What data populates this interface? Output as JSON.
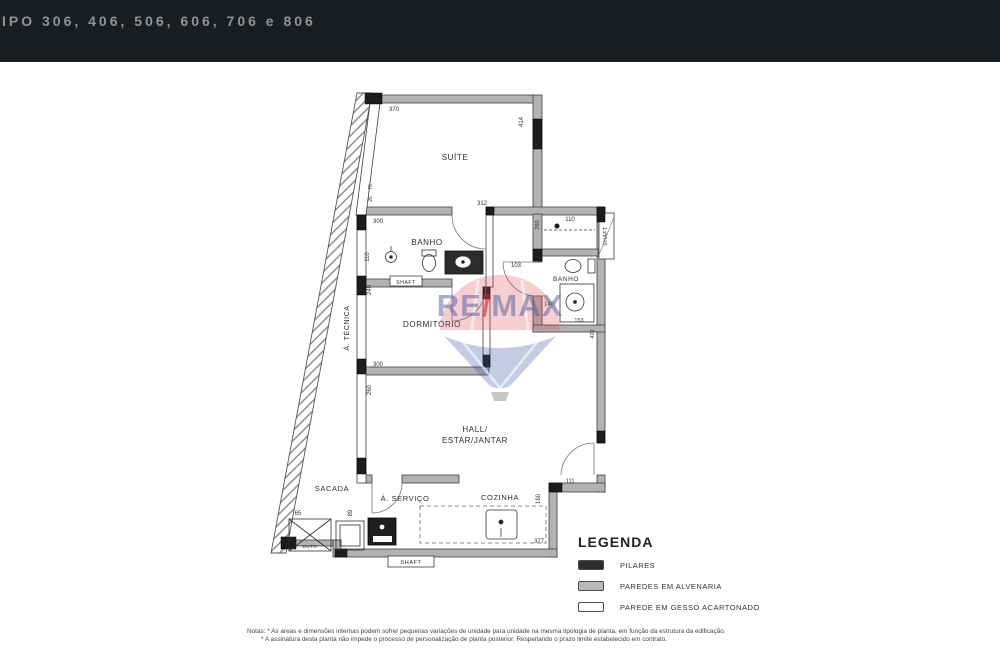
{
  "header": {
    "title": "IPO 306, 406, 506, 606, 706 e 806"
  },
  "plan": {
    "rooms": {
      "suite": "SUÍTE",
      "banho1": "BANHO",
      "banho2": "BANHO",
      "dormitorio": "DORMITÓRIO",
      "area_tecnica": "Á. TÉCNICA",
      "hall1": "HALL/",
      "hall2": "ESTAR/JANTAR",
      "sacada": "SACADA",
      "servico": "Á. SERVIÇO",
      "cozinha": "COZINHA",
      "shaft1": "SHAFT",
      "shaft2": "SHAFT",
      "shaft3": "SHAFT",
      "duto": "DUTO"
    },
    "dims": {
      "d370": "370",
      "d414": "414",
      "d312": "312",
      "d300a": "300",
      "d110a": "110",
      "d140a": "140",
      "d103": "103",
      "d260a": "260",
      "d110b": "110",
      "d140b": "140",
      "d153": "153",
      "d422": "422",
      "d240": "240",
      "d300b": "300",
      "d260b": "260",
      "d75": "75",
      "d26": "26",
      "d160": "160",
      "d111": "111",
      "d377": "377",
      "d65": "65",
      "d89": "89"
    }
  },
  "watermark": {
    "re": "RE",
    "slash": "/",
    "max": "MAX"
  },
  "legend": {
    "title": "LEGENDA",
    "items": [
      {
        "label": "PILARES",
        "color": "#2e2e2e"
      },
      {
        "label": "PAREDES EM ALVENARIA",
        "color": "#b9b9b9"
      },
      {
        "label": "PAREDE EM GESSO ACARTONADO",
        "color": "#ffffff"
      }
    ]
  },
  "notes": {
    "line1": "Notas: * As áreas e dimensões internas podem sofrer pequenas variações de unidade para unidade na mesma tipologia de planta, em função da estrutura da edificação.",
    "line2": "* A assinatura desta planta não impede o processo de personalização de planta posterior. Respeitando o prazo limite estabelecido em contrato."
  }
}
